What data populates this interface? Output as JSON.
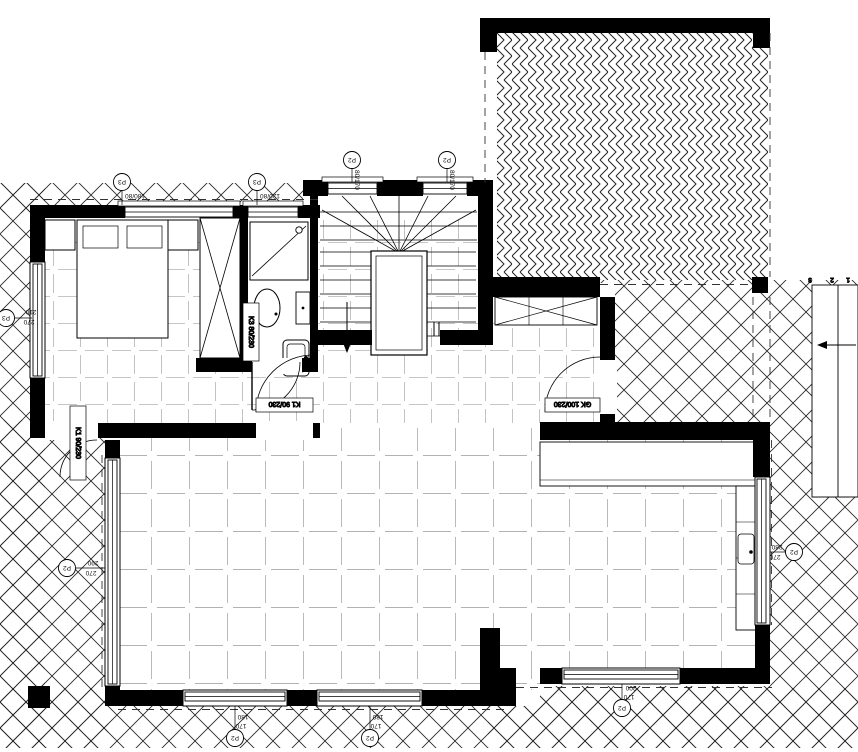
{
  "windows": {
    "bedroom_top": {
      "tag": "P3",
      "dim": "180/80"
    },
    "bathroom_top": {
      "tag": "P3",
      "dim": "120/80"
    },
    "stair_left": {
      "tag": "P2",
      "dim": "80/170"
    },
    "stair_right": {
      "tag": "P2",
      "dim": "80/170"
    },
    "west_bedroom": {
      "tag": "P3",
      "width": "210",
      "height": "270"
    },
    "west_living": {
      "tag": "P2",
      "width": "290",
      "height": "270"
    },
    "east_living": {
      "tag": "P2",
      "width": "280",
      "height": "270"
    },
    "south_window_1": {
      "tag": "P2",
      "width": "180",
      "height": "170"
    },
    "south_window_2": {
      "tag": "P2",
      "width": "180",
      "height": "170"
    },
    "south_window_3": {
      "tag": "P2",
      "width": "200",
      "height": "170"
    }
  },
  "doors": {
    "bathroom": {
      "label": "K3 80/230"
    },
    "bedroom_west": {
      "label": "K1 90/230"
    },
    "living_hall": {
      "label": "K1 90/230"
    },
    "entry": {
      "label": "GK 100/230"
    }
  },
  "exterior_steps": {
    "step_1": "1",
    "step_2": "2",
    "step_3": "3"
  },
  "colors": {
    "wall": "#000000",
    "hatch": "#2a2a2a",
    "tile": "#666666",
    "background": "#ffffff"
  }
}
